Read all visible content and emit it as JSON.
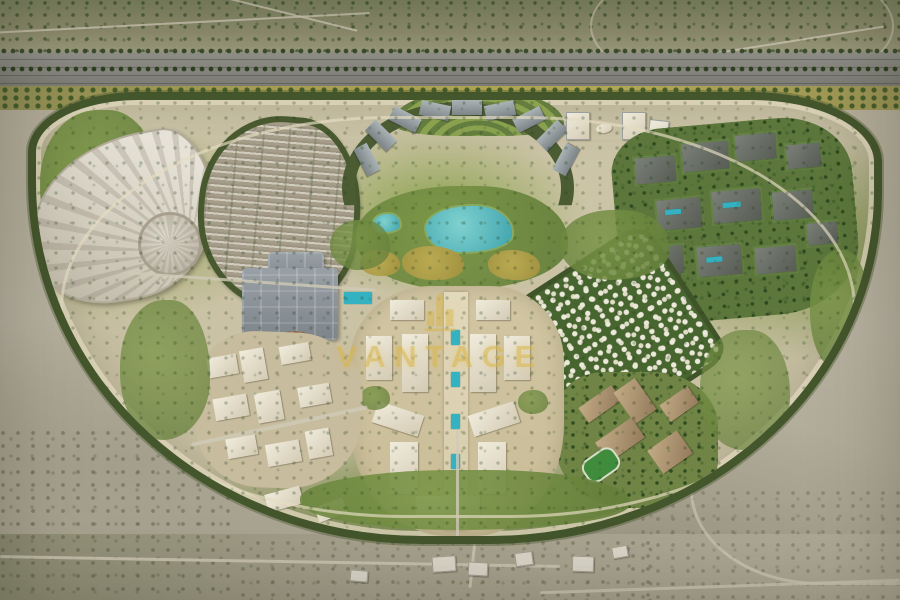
{
  "scene": {
    "type": "aerial-masterplan-render",
    "description": "Bird's-eye 3D render of a master-planned desert community: perimeter highway, tree-ringed oval site, expo hall, parking field, tower crescent, central park with lagoon, villa quilt district, mall, school campus and central boulevard core",
    "watermark": {
      "text": "VANTAGE",
      "icon": "tower-emblem-icon",
      "color": "#D9B64A"
    },
    "palette": {
      "desert": "#B3AC9A",
      "scrubland": "#82875F",
      "highway_asphalt": "#86857E",
      "greenbelt": "#44562C",
      "park_green": "#7B9647",
      "lagoon_water": "#4FB3B8",
      "pool_water": "#35B2C2",
      "road_sand": "#DED6BA",
      "building_white": "#ECE8DA",
      "building_gray": "#8E979B",
      "building_dark": "#676C63",
      "campus_tan": "#B59A76",
      "plaza_terracotta": "#9C6B4F",
      "lawn_gold": "#B7A74E"
    },
    "regions": [
      {
        "name": "north-scrubland"
      },
      {
        "name": "perimeter-highway"
      },
      {
        "name": "community-oval"
      },
      {
        "name": "expo-hall"
      },
      {
        "name": "parking-grid"
      },
      {
        "name": "crescent-residences"
      },
      {
        "name": "formal-garden"
      },
      {
        "name": "central-park"
      },
      {
        "name": "lagoon"
      },
      {
        "name": "twin-towers"
      },
      {
        "name": "east-apartment-district"
      },
      {
        "name": "villa-quilt-district"
      },
      {
        "name": "school-campus"
      },
      {
        "name": "central-core-boulevard"
      },
      {
        "name": "mall-complex"
      },
      {
        "name": "amphitheater-plaza"
      },
      {
        "name": "west-residential-cluster"
      },
      {
        "name": "south-desert"
      }
    ]
  }
}
